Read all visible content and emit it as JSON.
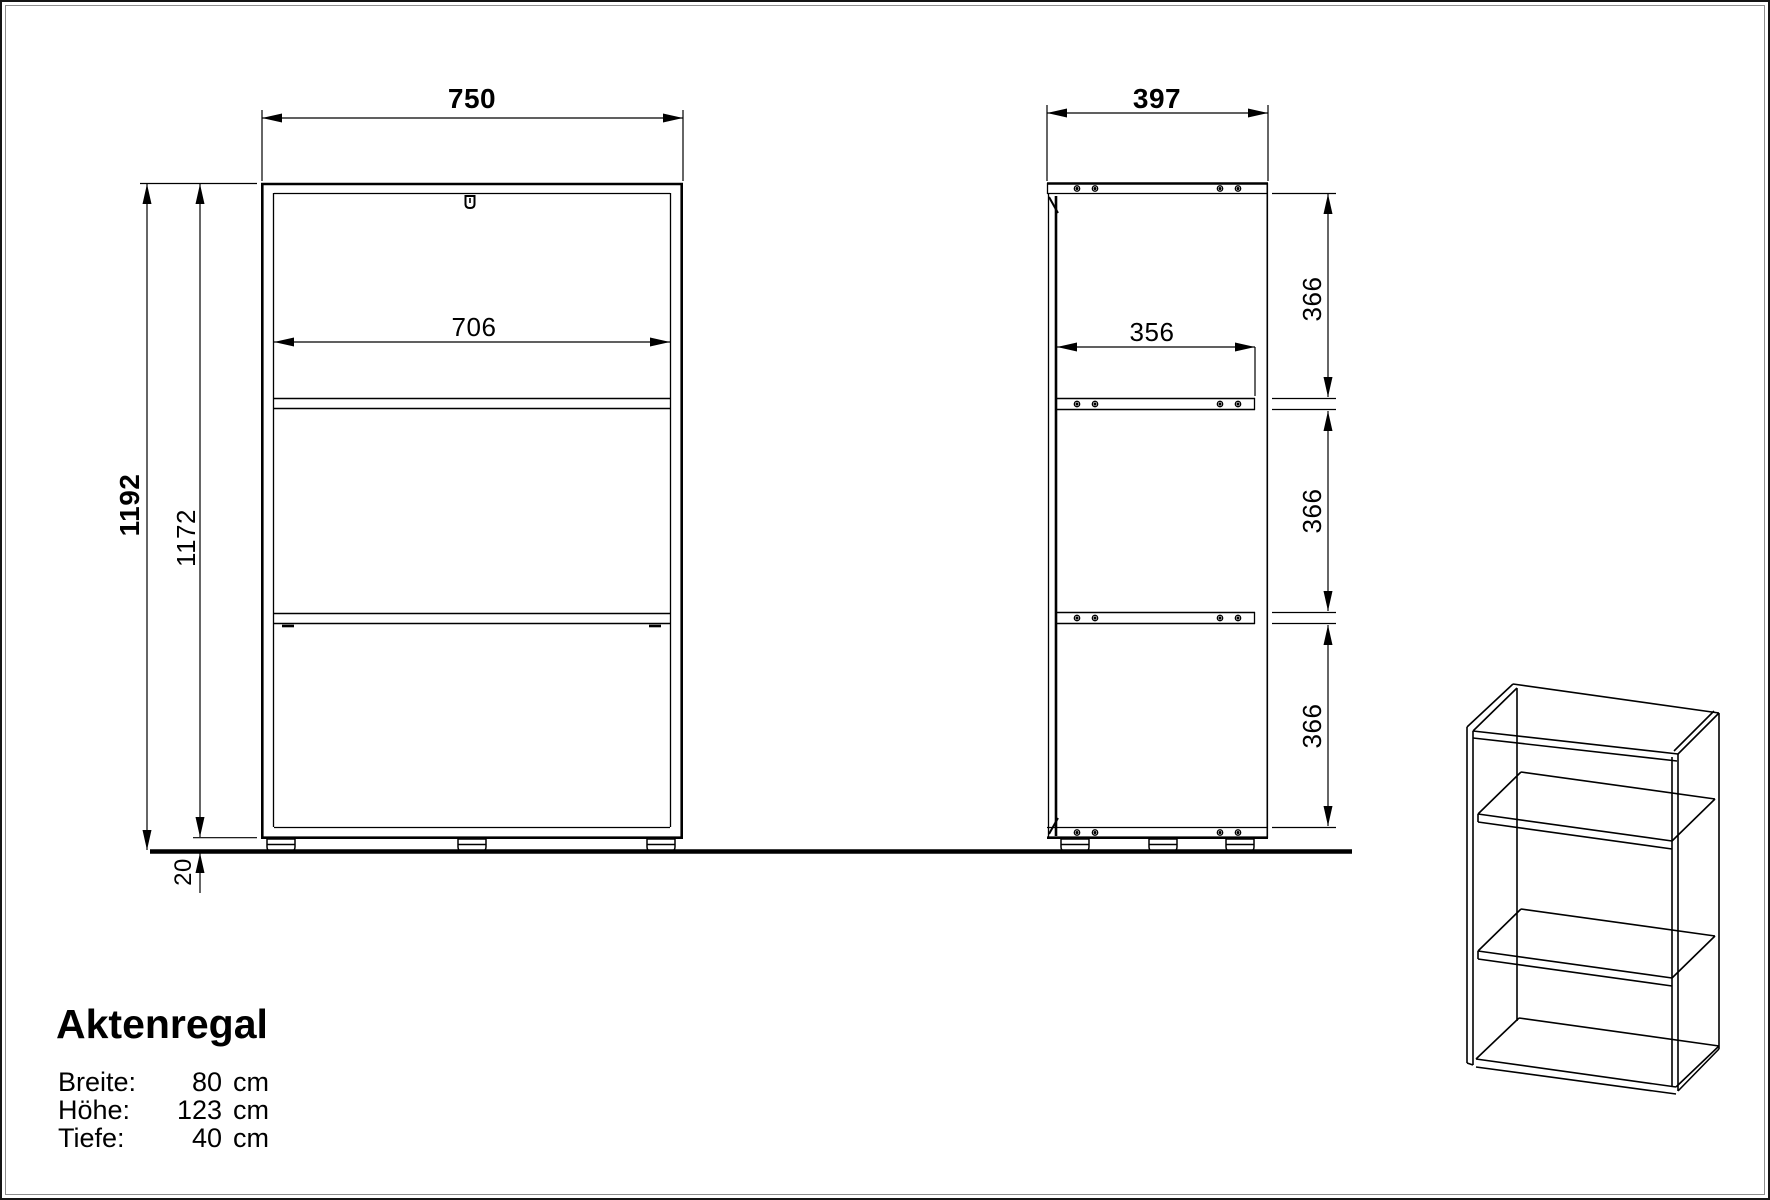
{
  "drawing": {
    "title": "Aktenregal",
    "specs": [
      {
        "label": "Breite:",
        "value": "80",
        "unit": "cm"
      },
      {
        "label": "Höhe:",
        "value": "123",
        "unit": "cm"
      },
      {
        "label": "Tiefe:",
        "value": "40",
        "unit": "cm"
      }
    ],
    "front_view": {
      "width_mm": "750",
      "inner_width_mm": "706",
      "height_mm": "1192",
      "inner_height_mm": "1172",
      "foot_height_mm": "20"
    },
    "side_view": {
      "depth_mm": "397",
      "shelf_depth_mm": "356",
      "compartments_mm": [
        "366",
        "366",
        "366"
      ]
    },
    "colors": {
      "line": "#000000",
      "background": "#ffffff",
      "border_outer": "#141414",
      "border_inner": "#8e8e8e"
    }
  }
}
